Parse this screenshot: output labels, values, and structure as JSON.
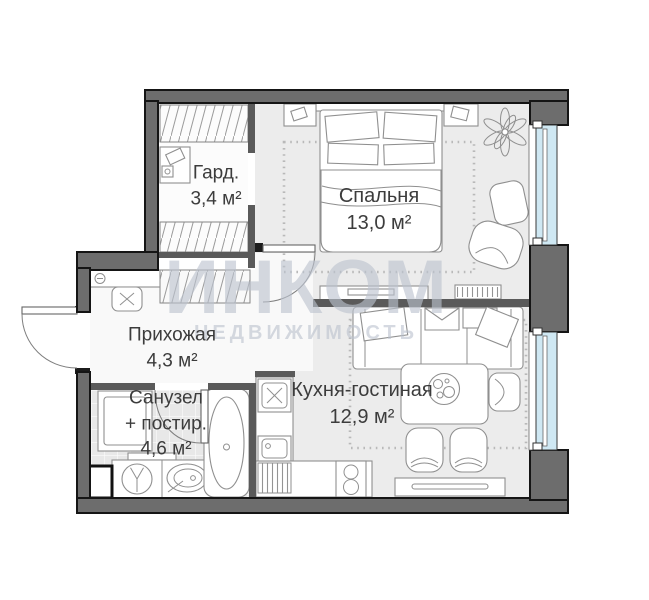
{
  "brand": {
    "name": "ИНКОМ",
    "tagline": "НЕДВИЖИМОСТЬ"
  },
  "rooms": {
    "wardrobe": {
      "name": "Гард.",
      "area": "3,4 м²"
    },
    "bedroom": {
      "name": "Спальня",
      "area": "13,0 м²"
    },
    "hallway": {
      "name": "Прихожая",
      "area": "4,3 м²"
    },
    "bathroom": {
      "name": "Санузел",
      "name_line2": "+ постир.",
      "area": "4,6 м²"
    },
    "kitchen_living": {
      "name": "Кухня-гостиная",
      "area": "12,9 м²"
    }
  },
  "colors": {
    "wall": "#6d6d6d",
    "wall-inner": "#5a5a5a",
    "floor": "#ececec",
    "floor-light": "#f9f9f9",
    "floor-bath": "#e8e8e8",
    "window": "#cfe8f3",
    "line": "#8f8f8f",
    "watermark": "#bcc3cf"
  }
}
